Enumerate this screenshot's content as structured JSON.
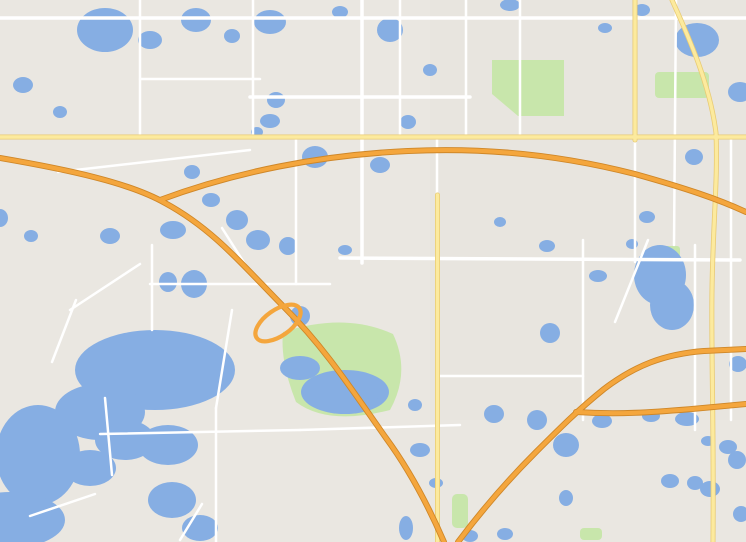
{
  "canvas": {
    "width": 746,
    "height": 542
  },
  "colors": {
    "land": "#eae7e1",
    "water": "#86aee3",
    "park": "#c8e6ab",
    "highway_orange": "#f4a63d",
    "road_yellow": "#fcea9e",
    "marker_purple": "#a32ab6",
    "marker_red": "#ea4538",
    "marker_green": "#0d9b53",
    "callout_bg": "#ffffff",
    "callout_border": "#1c1c1c"
  },
  "callouts": [
    {
      "id": "hataway",
      "label": "Hataway Residence",
      "x": 25,
      "y": 64,
      "w": 148,
      "h": 31,
      "fs": 14.5,
      "wedges": [
        {
          "f": 1,
          "pts": [
            [
              29,
              65
            ],
            [
              85,
              65
            ],
            [
              40,
              44
            ]
          ]
        }
      ]
    },
    {
      "id": "workplace",
      "label": "Jenn's Workplace",
      "x": 5,
      "y": 212,
      "w": 150,
      "h": 31,
      "fs": 14.5,
      "wedges": [
        {
          "f": 0,
          "pts": [
            [
              30,
              213
            ],
            [
              69,
              171
            ]
          ]
        },
        {
          "f": 0,
          "pts": [
            [
              66,
              213
            ],
            [
              71,
              171
            ]
          ]
        }
      ]
    },
    {
      "id": "taproom",
      "label": "Tap Room/Gym Areas",
      "x": 303,
      "y": 176,
      "w": 145,
      "h": 32,
      "fs": 13.5,
      "wedges": [
        {
          "f": 1,
          "pts": [
            [
              352,
              207
            ],
            [
              413,
              207
            ],
            [
              388,
              256
            ]
          ]
        }
      ]
    },
    {
      "id": "aprox",
      "label": "Jenn Aprox. Area of\nRes.--Prior To Nov.\n2005",
      "x": 468,
      "y": 160,
      "w": 152,
      "h": 78,
      "fs": 13,
      "wedges": [
        {
          "f": 0,
          "pts": [
            [
              468,
              172
            ],
            [
              421,
              257
            ]
          ]
        },
        {
          "f": 0,
          "pts": [
            [
              468,
              233
            ],
            [
              421,
              257
            ]
          ]
        }
      ]
    },
    {
      "id": "condo",
      "label": "Jenn's Condo Area",
      "x": 584,
      "y": 366,
      "w": 152,
      "h": 33,
      "fs": 14,
      "wedges": [
        {
          "f": 1,
          "pts": [
            [
              607,
              398
            ],
            [
              629,
              398
            ],
            [
              600,
              467
            ]
          ]
        },
        {
          "f": 0,
          "pts": [
            [
              641,
              398
            ],
            [
              620,
              451
            ]
          ]
        },
        {
          "f": 0,
          "pts": [
            [
              654,
              398
            ],
            [
              627,
              450
            ]
          ]
        }
      ]
    },
    {
      "id": "mall",
      "label": "Mall at Millenia",
      "x": 318,
      "y": 440,
      "w": 138,
      "h": 38,
      "fs": 15,
      "wedges": [
        {
          "f": 0,
          "pts": [
            [
              456,
              453
            ],
            [
              552,
              464
            ]
          ]
        },
        {
          "f": 0,
          "pts": [
            [
              456,
              473
            ],
            [
              547,
              471
            ]
          ]
        }
      ]
    },
    {
      "id": "hog",
      "label": "HOG Area",
      "x": 590,
      "y": 498,
      "w": 140,
      "h": 33,
      "fs": 14.5,
      "wedges": [
        {
          "f": 1,
          "pts": [
            [
              636,
              498
            ],
            [
              663,
              498
            ],
            [
              657,
              470
            ]
          ]
        }
      ]
    }
  ],
  "map": {
    "labels": [
      {
        "t": "Rewis St",
        "x": 75,
        "y": 8,
        "k": "road",
        "r": -8
      },
      {
        "t": "Silver Star Rd",
        "x": 222,
        "y": 11,
        "k": "road",
        "r": -20
      },
      {
        "t": "Ocoee",
        "x": 57,
        "y": 45,
        "k": "place"
      },
      {
        "t": "White Rd",
        "x": 203,
        "y": 79,
        "k": "road"
      },
      {
        "t": "Ston",
        "x": 8,
        "y": 99,
        "k": "road"
      },
      {
        "t": "Balboa Dr",
        "x": 297,
        "y": 97,
        "k": "road"
      },
      {
        "t": "Vernon St",
        "x": 383,
        "y": 97,
        "k": "road"
      },
      {
        "t": "Good Homes Rd",
        "x": 253,
        "y": 32,
        "k": "road",
        "r": -90
      },
      {
        "t": "N Hiawassee Rd",
        "x": 362,
        "y": 57,
        "k": "road",
        "r": -90
      },
      {
        "t": "N Powers Dr",
        "x": 400,
        "y": 34,
        "k": "road",
        "r": -90
      },
      {
        "t": "N Hastings St",
        "x": 437,
        "y": 100,
        "k": "road",
        "r": -90
      },
      {
        "t": "N Pine Hills Rd",
        "x": 466,
        "y": 38,
        "k": "road",
        "r": -90
      },
      {
        "t": "Pine Hills",
        "x": 455,
        "y": 106,
        "k": "place"
      },
      {
        "t": "Barnett Park",
        "x": 527,
        "y": 97,
        "k": "park",
        "s": 11
      },
      {
        "t": "Orlando",
        "x": 738,
        "y": 31,
        "k": "place"
      },
      {
        "t": "COLLEGE",
        "x": 736,
        "y": 52,
        "k": "area",
        "s": 8.5
      },
      {
        "t": "W Co",
        "x": 733,
        "y": 130,
        "k": "road"
      },
      {
        "t": "W Ame",
        "x": 738,
        "y": 145,
        "k": "road"
      },
      {
        "t": "W Rob",
        "x": 738,
        "y": 163,
        "k": "road"
      },
      {
        "t": "W Cen",
        "x": 738,
        "y": 182,
        "k": "road"
      },
      {
        "t": "N Tampa Ave",
        "x": 676,
        "y": 163,
        "k": "road",
        "r": -90
      },
      {
        "t": "World Stadium",
        "x": 640,
        "y": 201,
        "k": "poi",
        "s": 11.5
      },
      {
        "t": "Old Winter Garden Rd",
        "x": 130,
        "y": 159,
        "k": "road",
        "r": 7
      },
      {
        "t": "Spessard L. Holland East-West Expy",
        "x": 281,
        "y": 159,
        "k": "road",
        "r": -6
      },
      {
        "t": "Tomyn B",
        "x": 30,
        "y": 172,
        "k": "road",
        "r": 12
      },
      {
        "t": "Turnpike",
        "x": -6,
        "y": 163,
        "k": "hwy",
        "r": 8
      },
      {
        "t": "Gotha",
        "x": 148,
        "y": 257,
        "k": "place",
        "s": 11
      },
      {
        "t": "S Apopka Vine",
        "x": 233,
        "y": 250,
        "k": "road",
        "r": -58
      },
      {
        "t": "Steer Lake Rd",
        "x": 258,
        "y": 284,
        "k": "road"
      },
      {
        "t": "wood Ranch Rd",
        "x": 300,
        "y": 250,
        "k": "road",
        "r": -90
      },
      {
        "t": "Hempel Ave",
        "x": 152,
        "y": 293,
        "k": "road",
        "r": -90
      },
      {
        "t": "Park Ridge Gotha Rd",
        "x": 102,
        "y": 288,
        "k": "road",
        "r": -24
      },
      {
        "t": "Maguire Rd",
        "x": 64,
        "y": 331,
        "k": "road",
        "r": -72
      },
      {
        "t": "Park Ave",
        "x": 25,
        "y": 371,
        "k": "road",
        "r": -8
      },
      {
        "t": "Florida's Turnpike",
        "x": 196,
        "y": 275,
        "k": "hwy",
        "r": 42,
        "s": 11
      },
      {
        "t": "Hiawassee Rd",
        "x": 364,
        "y": 238,
        "k": "road",
        "r": -86
      },
      {
        "t": "Raleigh St",
        "x": 462,
        "y": 256,
        "k": "road"
      },
      {
        "t": "Valencia College,",
        "x": 405,
        "y": 291,
        "k": "campus"
      },
      {
        "t": "West Campus",
        "x": 405,
        "y": 304,
        "k": "campus"
      },
      {
        "t": "METRO WEST",
        "x": 405,
        "y": 322,
        "k": "area"
      },
      {
        "t": "SOUTHWEST",
        "x": 450,
        "y": 347,
        "k": "area"
      },
      {
        "t": "ORLANDO",
        "x": 450,
        "y": 359,
        "k": "area"
      },
      {
        "t": "Bill Frederick",
        "x": 335,
        "y": 357,
        "k": "park",
        "s": 11
      },
      {
        "t": "Park",
        "x": 335,
        "y": 370,
        "k": "park",
        "s": 11
      },
      {
        "t": "B McLeod Rd",
        "x": 475,
        "y": 376,
        "k": "road"
      },
      {
        "t": "35th St",
        "x": 534,
        "y": 377,
        "k": "road",
        "s": 8.5
      },
      {
        "t": "36th St",
        "x": 531,
        "y": 389,
        "k": "road",
        "s": 8.5
      },
      {
        "t": "Columbia St",
        "x": 596,
        "y": 261,
        "k": "road"
      },
      {
        "t": "S John Young Pkwy",
        "x": 629,
        "y": 285,
        "k": "road",
        "r": -70
      },
      {
        "t": "Bruton Blvd",
        "x": 583,
        "y": 327,
        "k": "road",
        "r": -90
      },
      {
        "t": "Rio Grande Ave",
        "x": 695,
        "y": 303,
        "k": "road",
        "r": -90
      },
      {
        "t": "S Westmoreland Dr",
        "x": 732,
        "y": 264,
        "k": "road",
        "r": -90
      },
      {
        "t": "W Gor",
        "x": 738,
        "y": 242,
        "k": "road"
      },
      {
        "t": "Lake Down",
        "x": 162,
        "y": 386,
        "k": "water",
        "r": -4
      },
      {
        "t": "Windermere",
        "x": 100,
        "y": 423,
        "k": "place",
        "s": 12
      },
      {
        "t": "Main St",
        "x": 106,
        "y": 450,
        "k": "road",
        "r": -78
      },
      {
        "t": "Conroy Rd",
        "x": 244,
        "y": 432,
        "k": "road"
      },
      {
        "t": "Chase Rd",
        "x": 69,
        "y": 503,
        "k": "road",
        "r": -18
      },
      {
        "t": "S Apopka Vinelan",
        "x": 216,
        "y": 510,
        "k": "road",
        "r": -90
      },
      {
        "t": "Bay Side Dr",
        "x": 191,
        "y": 521,
        "k": "road",
        "r": -52
      },
      {
        "t": "The Wizarding",
        "x": 346,
        "y": 490,
        "k": "poi"
      },
      {
        "t": "World of Harry Potter...",
        "x": 341,
        "y": 501,
        "k": "poi"
      },
      {
        "t": "Universal Orlando Resort",
        "x": 334,
        "y": 531,
        "k": "poi"
      },
      {
        "t": "The Holy Land",
        "x": 512,
        "y": 417,
        "k": "poi"
      },
      {
        "t": "Experience",
        "x": 516,
        "y": 429,
        "k": "poi"
      },
      {
        "t": "Orlando International",
        "x": 520,
        "y": 509,
        "k": "poib"
      },
      {
        "t": "Premium Outlets",
        "x": 516,
        "y": 522,
        "k": "poib"
      },
      {
        "t": "MILLENIA",
        "x": 561,
        "y": 462,
        "k": "area",
        "s": 9.5
      },
      {
        "t": "W Oak",
        "x": 736,
        "y": 534,
        "k": "road"
      }
    ],
    "shields": [
      {
        "type": "oval",
        "num": "438",
        "x": 123,
        "y": 21
      },
      {
        "type": "oval",
        "num": "438",
        "x": 357,
        "y": 8
      },
      {
        "type": "oval",
        "num": "438",
        "x": 553,
        "y": 16
      },
      {
        "type": "oval",
        "num": "50",
        "x": 10,
        "y": 134
      },
      {
        "type": "oval",
        "num": "50",
        "x": 392,
        "y": 134
      },
      {
        "type": "oval",
        "num": "50",
        "x": 698,
        "y": 132
      },
      {
        "type": "oval",
        "num": "526",
        "x": 206,
        "y": 181
      },
      {
        "type": "oval",
        "num": "526",
        "x": 457,
        "y": 193
      },
      {
        "type": "oval",
        "num": "408",
        "x": 152,
        "y": 197
      },
      {
        "type": "oval",
        "num": "408",
        "x": 405,
        "y": 150
      },
      {
        "type": "oval",
        "num": "441",
        "x": 719,
        "y": 107
      },
      {
        "type": "oval",
        "num": "423",
        "x": 637,
        "y": 154
      },
      {
        "type": "oval",
        "num": "400",
        "x": 680,
        "y": 352
      },
      {
        "type": "oval",
        "num": "435",
        "x": 438,
        "y": 514
      },
      {
        "type": "interstate",
        "num": "4",
        "x": 570,
        "y": 411
      },
      {
        "type": "interstate",
        "num": "4",
        "x": 504,
        "y": 479
      }
    ],
    "markers": [
      {
        "c": "p",
        "n": "5",
        "x": 628,
        "y": 428
      },
      {
        "c": "p",
        "n": "",
        "x": 554,
        "y": 478
      },
      {
        "c": "r",
        "n": "",
        "x": 596,
        "y": 469
      },
      {
        "c": "p",
        "n": "3",
        "x": 648,
        "y": 453
      },
      {
        "c": "p",
        "n": "7",
        "x": 632,
        "y": 451
      },
      {
        "c": "p",
        "n": "4",
        "x": 617,
        "y": 451
      },
      {
        "c": "p",
        "n": "6",
        "x": 592,
        "y": 457
      },
      {
        "c": "r",
        "n": "6",
        "x": 660,
        "y": 459
      },
      {
        "c": "p",
        "n": "8",
        "x": 663,
        "y": 476
      },
      {
        "c": "p",
        "n": "11",
        "x": 694,
        "y": 429
      },
      {
        "c": "p",
        "n": "9",
        "x": 719,
        "y": 493
      },
      {
        "c": "p",
        "n": "10",
        "x": 700,
        "y": 538
      },
      {
        "c": "p",
        "n": "12",
        "x": 450,
        "y": 490
      },
      {
        "c": "r",
        "n": "1",
        "x": 483,
        "y": 508
      },
      {
        "c": "p",
        "n": "14",
        "x": 437,
        "y": 377
      },
      {
        "c": "p",
        "n": "16",
        "x": 608,
        "y": 338
      },
      {
        "c": "p",
        "n": "18",
        "x": 70,
        "y": 159
      },
      {
        "c": "g",
        "icon": "car-icon",
        "x": 49,
        "y": 30
      },
      {
        "c": "g",
        "icon": "house-icon",
        "x": 33,
        "y": 41
      },
      {
        "c": "g",
        "icon": "dumbbell-icon",
        "x": 384,
        "y": 262
      },
      {
        "c": "g",
        "icon": "beer-mug-icon",
        "x": 412,
        "y": 262
      },
      {
        "c": "g",
        "icon": "bus-icon",
        "x": 516,
        "y": 453
      },
      {
        "c": "g",
        "icon": "martini-icon",
        "x": 558,
        "y": 466
      },
      {
        "c": "g",
        "icon": "fuel-pump-icon",
        "x": 628,
        "y": 464
      },
      {
        "c": "g",
        "icon": "restaurant-icon",
        "x": 583,
        "y": 527
      }
    ],
    "poi_icons": [
      {
        "icon": "stadium-icon",
        "x": 688,
        "y": 200
      },
      {
        "icon": "holy-land-icon",
        "x": 556,
        "y": 420
      },
      {
        "icon": "harry-potter-icon",
        "x": 391,
        "y": 497
      },
      {
        "icon": "universal-icon",
        "x": 398,
        "y": 530
      },
      {
        "icon": "transit-icon",
        "x": 472,
        "y": 529
      }
    ]
  }
}
